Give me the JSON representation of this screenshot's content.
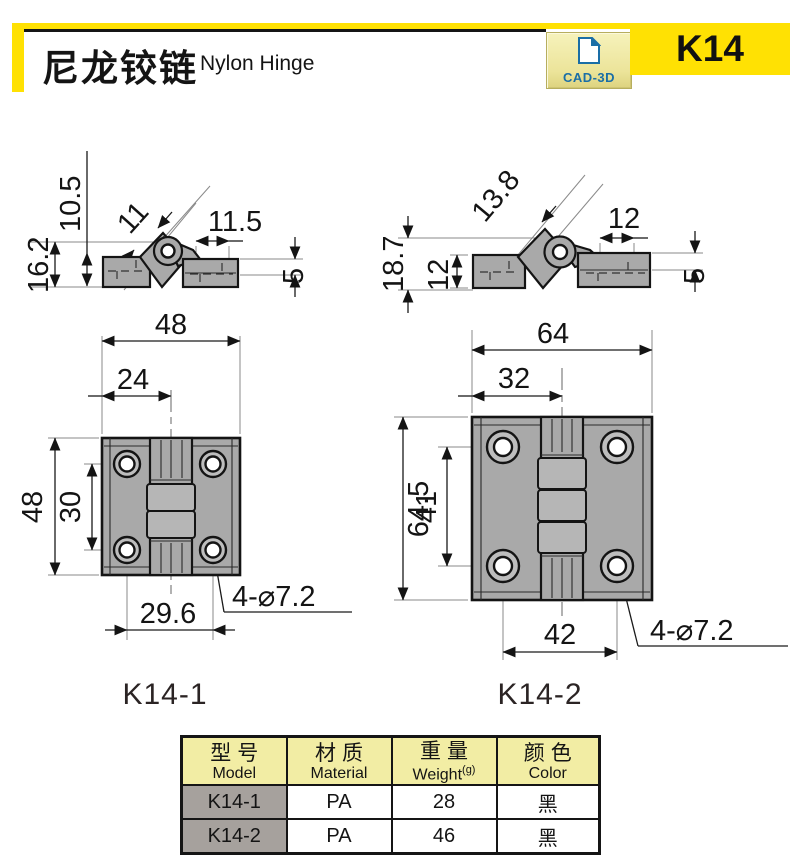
{
  "header": {
    "title_zh": "尼龙铰链",
    "title_en": "Nylon Hinge",
    "badge_label": "CAD-3D",
    "product_code": "K14"
  },
  "captions": {
    "left": "K14-1",
    "right": "K14-2"
  },
  "side_view_1": {
    "dim_height_total": "16.2",
    "dim_pin_height": "10.5",
    "dim_knuckle_width": "11",
    "dim_leaf_length": "11.5",
    "dim_thickness": "5"
  },
  "side_view_2": {
    "dim_height_total": "18.7",
    "dim_leaf_height": "12",
    "dim_knuckle_width": "13.8",
    "dim_leaf_length": "12",
    "dim_thickness": "5"
  },
  "front_view_1": {
    "dim_width": "48",
    "dim_center": "24",
    "dim_height": "48",
    "dim_hole_span_v": "30",
    "dim_hole_span_h": "29.6",
    "dim_holes": "4-⌀7.2"
  },
  "front_view_2": {
    "dim_width": "64",
    "dim_center": "32",
    "dim_height": "64.5",
    "dim_hole_span_v": "41",
    "dim_hole_span_h": "42",
    "dim_holes": "4-⌀7.2"
  },
  "table": {
    "headers": [
      {
        "zh": "型号",
        "en": "Model",
        "sup": ""
      },
      {
        "zh": "材质",
        "en": "Material",
        "sup": ""
      },
      {
        "zh": "重量",
        "en": "Weight",
        "sup": "(g)"
      },
      {
        "zh": "颜色",
        "en": "Color",
        "sup": ""
      }
    ],
    "rows": [
      [
        "K14-1",
        "PA",
        "28",
        "黑"
      ],
      [
        "K14-2",
        "PA",
        "46",
        "黑"
      ]
    ]
  },
  "colors": {
    "accent_yellow": "#FFE103",
    "pale_yellow": "#F2EDA4",
    "badge_blue": "#1A6EA6",
    "row_label_gray": "#A6A19D",
    "drawing_gray": "#A9A9A9"
  }
}
